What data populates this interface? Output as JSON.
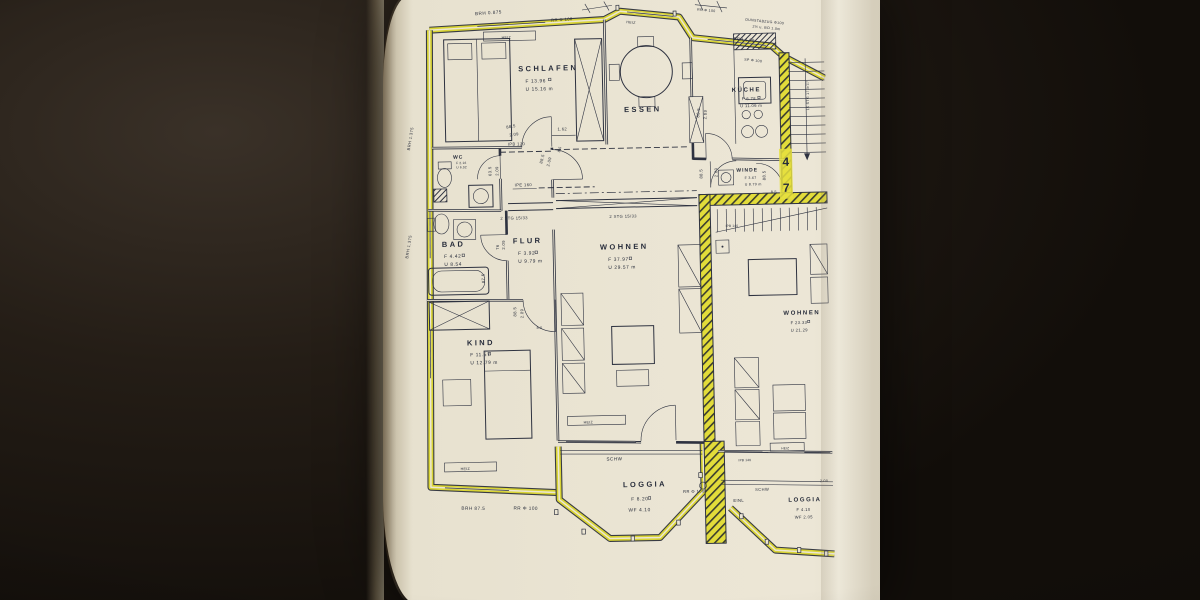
{
  "rooms": {
    "schlafen": {
      "name": "SCHLAFEN",
      "l1": "F 13.96",
      "l2": "U 15.16 m"
    },
    "essen": {
      "name": "ESSEN"
    },
    "kueche": {
      "name": "KÜCHE",
      "l1": "F 6.78",
      "l2": "U 11.06 m"
    },
    "wc": {
      "name": "WC",
      "l1": "F 2.16",
      "l2": "U 6.02"
    },
    "bad": {
      "name": "BAD",
      "l1": "F 4.42",
      "l2": "U 8.54"
    },
    "flur": {
      "name": "FLUR",
      "l1": "F 3.92",
      "l2": "U 9.79 m"
    },
    "winde": {
      "name": "WINDE",
      "l1": "F 3.67",
      "l2": "U 8.79 m"
    },
    "wohnen": {
      "name": "WOHNEN",
      "l1": "F 37.97",
      "l2": "U 29.57 m"
    },
    "kind": {
      "name": "KIND",
      "l1": "F 11.57",
      "l2": "U 12.79 m"
    },
    "loggia": {
      "name": "LOGGIA",
      "l1": "F 8.20",
      "l2": "WF 4.10"
    },
    "wohnen2": {
      "name": "WOHNEN",
      "l1": "F 23.33",
      "l2": "U 21.29"
    },
    "loggia2": {
      "name": "LOGGIA",
      "l1": "F 4.10",
      "l2": "WF 2.05"
    }
  },
  "labels": {
    "brh_0875": "BRH 0.875",
    "rr_100": "RR Φ 100",
    "heiz": "HEIZ",
    "dunstabzug_1": "DUNSTABZUG Φ100",
    "dunstabzug_2": "2½ u. BO 1.0m",
    "brh_100": "BRH 1.00",
    "sp_100": "SP Φ 100",
    "ipb_120": "IPB 120",
    "ipe_160": "IPE 160",
    "ipb_140": "IPB 140",
    "stg_2": "2 STG 15/33",
    "stg_15": "15 STG 17.5/27",
    "brh_1375": "BRH 1.375",
    "brh_875": "BRH 87.5",
    "schw": "SCHW",
    "einl": "EINL",
    "unit_4": "4",
    "unit_7": "7"
  },
  "dims": {
    "d885": "88.5",
    "d209": "2.09",
    "d635": "63.5",
    "d76": "76",
    "d85": "8.5",
    "d875": "87.5",
    "d162": "1.62",
    "d200": "2.00"
  }
}
